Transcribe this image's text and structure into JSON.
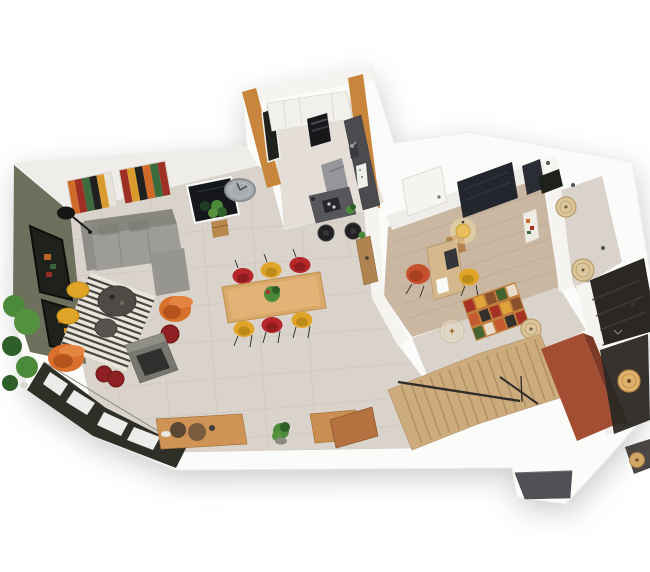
{
  "scene": {
    "type": "3d-floorplan-render",
    "view": "elevated-oblique-cutaway",
    "rooms": [
      {
        "name": "living-room",
        "furniture": [
          "l-shaped-gray-sofa",
          "striped-zebra-rug",
          "round-coffee-table",
          "round-side-table",
          "yellow-pouf",
          "yellow-pouf",
          "orange-armchair",
          "orange-armchair",
          "wine-pouf",
          "wine-pouf",
          "wine-pouf",
          "freestanding-fireplace",
          "arc-floor-lamp",
          "abstract-wall-art",
          "abstract-wall-art",
          "dark-wall-mirror",
          "round-wall-clock",
          "potted-plant",
          "plant-cluster",
          "glazed-window-wall",
          "olive-feature-wall",
          "wood-sideboard",
          "decor-vases"
        ]
      },
      {
        "name": "dining-area",
        "furniture": [
          "wood-dining-table",
          "red-shell-chair",
          "red-shell-chair",
          "red-shell-chair",
          "yellow-shell-chair",
          "yellow-shell-chair",
          "yellow-shell-chair",
          "table-plant-centerpiece"
        ]
      },
      {
        "name": "kitchen",
        "furniture": [
          "white-cabinet-run",
          "built-in-oven-column",
          "dark-counter",
          "sink-and-faucet",
          "island-with-cooktop",
          "bar-stool",
          "bar-stool",
          "gray-high-chair",
          "wood-bar-console",
          "wall-window",
          "small-plant"
        ]
      },
      {
        "name": "office-bedroom",
        "furniture": [
          "open-door",
          "wood-desk",
          "laptop",
          "paper-sheet",
          "red-desk-chair",
          "yellow-stool",
          "glowing-pendant-lamp",
          "dark-wardrobe",
          "wall-art"
        ]
      },
      {
        "name": "hallway",
        "furniture": [
          "mosaic-runner-rug",
          "glass-bulb-pendant",
          "rattan-pendant",
          "rattan-pendant",
          "rattan-pendant",
          "ceiling-spotlights",
          "framed-art",
          "dark-window"
        ]
      },
      {
        "name": "bathroom",
        "furniture": [
          "dark-paneled-walls"
        ]
      },
      {
        "name": "staircase",
        "furniture": [
          "wood-treads",
          "metal-handrail",
          "terracotta-accent-wall"
        ]
      },
      {
        "name": "entry",
        "furniture": [
          "spiral-pendant-lamp",
          "gray-landing-step"
        ]
      }
    ]
  },
  "colors": {
    "slab": "#fbfbfa",
    "wallShade": "#efede9",
    "wallLight": "#f6f4f1",
    "floorTile": "#d9d3cb",
    "floorTileKitchen": "#e4ded7",
    "floorWoodOffice": "#c9b7a2",
    "oliveWall": "#6e705e",
    "windowDark": "#1f211c",
    "glazingFrame": "#2e2f27",
    "paneWhite": "#fdfdfc",
    "kitchenOrange": "#c8863c",
    "counterDark": "#4b4b4f",
    "islandDark": "#57575b",
    "ovenBlack": "#17181a",
    "applianceWhite": "#eeeeea",
    "grayChair": "#96969a",
    "sofaGray": "#9d9c96",
    "sofaBack": "#87867f",
    "sofaArm": "#8f8e88",
    "sofaChaise": "#96958f",
    "rugBase": "#eae6dc",
    "rugStripe": "#2c2c28",
    "tableWood": "#d8a96a",
    "tableTop": "#e2b377",
    "sideboardWood": "#cf9455",
    "cabinetWood": "#c98f52",
    "benchWood": "#b5713f",
    "consoleWood": "#b08350",
    "chairRed": "#b5272a",
    "chairRedDeep": "#8e1d20",
    "chairYellow": "#e0a528",
    "chairYellowDeep": "#bb8a18",
    "accentOrange": "#d9702c",
    "accentOrangeDeep": "#b5531c",
    "accentOrangeLight": "#e58440",
    "pouffeWine": "#8e2023",
    "fireplaceGray": "#77766f",
    "fireplaceTop": "#8f8e87",
    "fireplaceDark": "#2f2f2d",
    "clockGray": "#a7acae",
    "mirrorDark": "#15171b",
    "plantGreen": "#4a8a39",
    "plantLight": "#54923f",
    "plantDeep": "#2e5f28",
    "potWood": "#b8884f",
    "deskWood": "#d6b88d",
    "laptopDark": "#35363a",
    "wardrobeDark": "#23262c",
    "officeChairRed": "#c6502e",
    "officeChairRedDeep": "#a8401f",
    "pendantGlow": "#e9bf5e",
    "pendantGlowHalo": "#f5dfa4",
    "pendantBeige": "#dcc79c",
    "pendantGlass": "#e8ddcc",
    "pendantRing": "#b89b6a",
    "stairWood": "#ccab7c",
    "stairLine": "#a9855a",
    "railDark": "#2e2d2b",
    "terracotta": "#a34d33",
    "terracottaShade": "#7c3a26",
    "darkRoom": "#2b2723",
    "darkRoomStreak": "#473f36",
    "entryStep": "#505156",
    "artOrange": "#cf6a28",
    "artRed": "#9e2f24",
    "artGreen": "#3c6b3e",
    "artBlack": "#20201e",
    "artCream": "#e8e3d8",
    "artMustard": "#d99a2e",
    "paintSeqA": [
      "#cf6a28",
      "#9e2f24",
      "#3c6b3e",
      "#20201e",
      "#d99a2e",
      "#e8e3d8"
    ],
    "paintSeqB": [
      "#9e2f24",
      "#d99a2e",
      "#20201e",
      "#cf6a28",
      "#3c6b3e",
      "#9e2f24"
    ],
    "mosaic": [
      "#a63226",
      "#e0a33c",
      "#8a512c",
      "#44632f",
      "#e8dcc8",
      "#c45a2e",
      "#33302c"
    ]
  }
}
